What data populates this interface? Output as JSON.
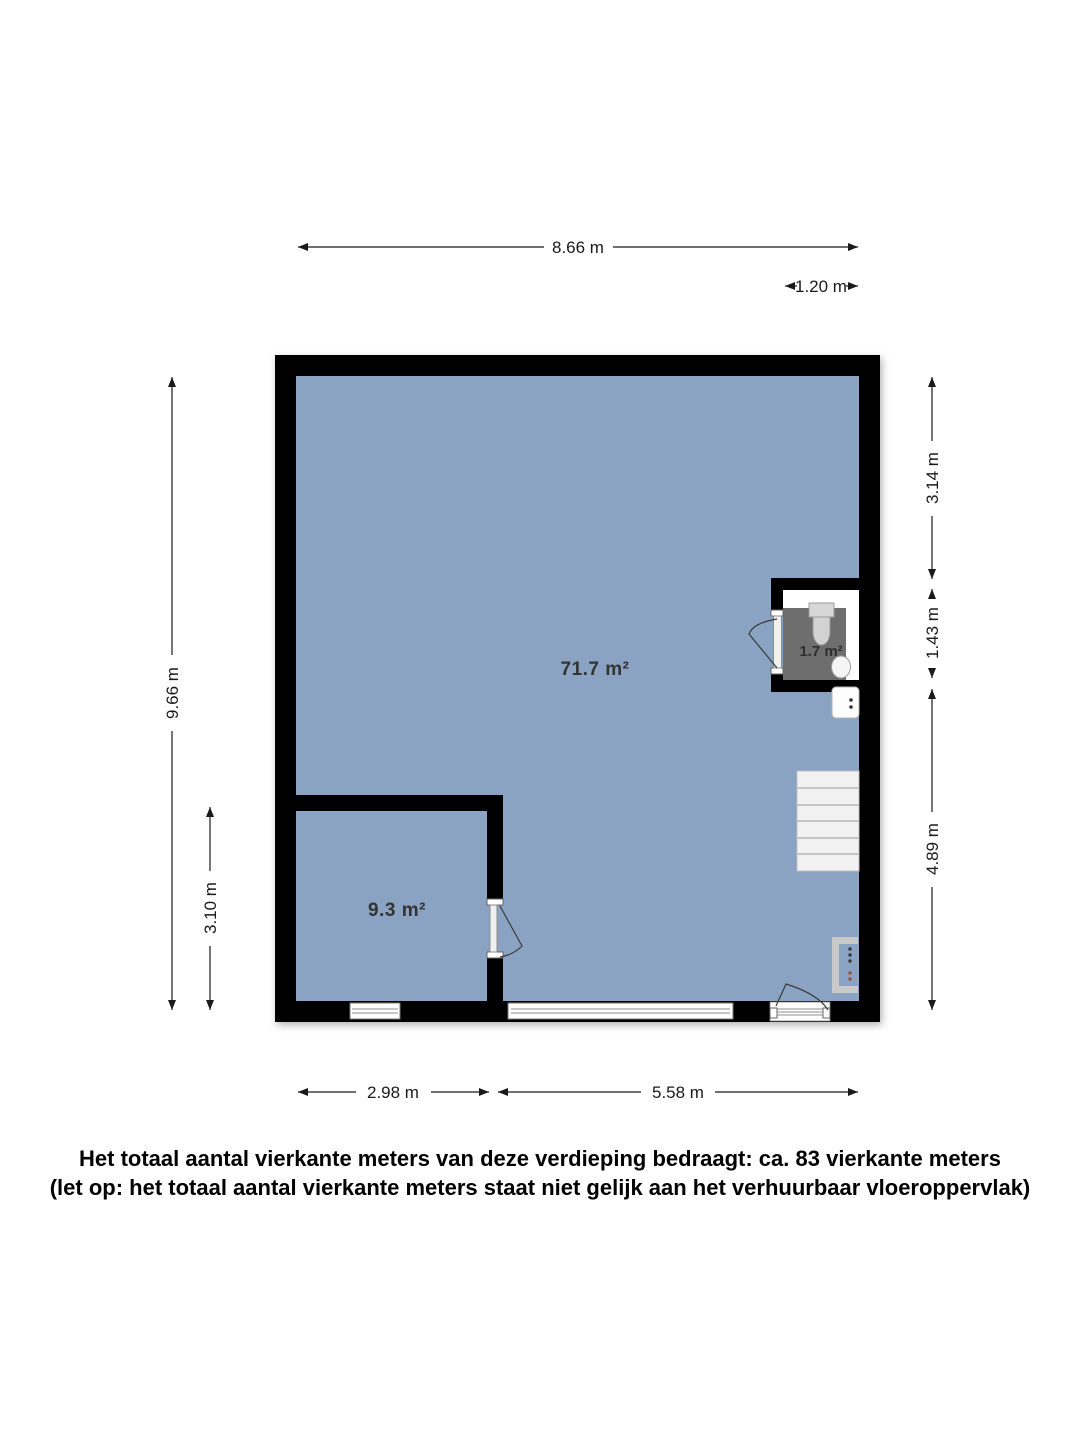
{
  "floorplan": {
    "colors": {
      "floor": "#8aa3c2",
      "wall": "#000000",
      "bathroom_floor": "#ffffff",
      "bathroom_tile": "#6e6e6e",
      "stairs": "#f2f2f2",
      "fixture_gray": "#c9c9c9"
    },
    "rooms": [
      {
        "id": "main-room",
        "area_label": "71.7 m²"
      },
      {
        "id": "side-room",
        "area_label": "9.3 m²"
      },
      {
        "id": "bathroom",
        "area_label": "1.7 m²"
      }
    ],
    "dimensions": {
      "top_width": "8.66 m",
      "bathroom_width": "1.20 m",
      "left_total_height": "9.66 m",
      "side_room_height": "3.10 m",
      "right_upper": "3.14 m",
      "right_bathroom": "1.43 m",
      "right_lower": "4.89 m",
      "bottom_side_room": "2.98 m",
      "bottom_main": "5.58 m"
    }
  },
  "footer": {
    "line1": "Het totaal aantal vierkante meters van deze verdieping bedraagt: ca. 83 vierkante meters",
    "line2": "(let op: het totaal aantal vierkante meters staat niet gelijk aan het verhuurbaar vloeroppervlak)"
  }
}
